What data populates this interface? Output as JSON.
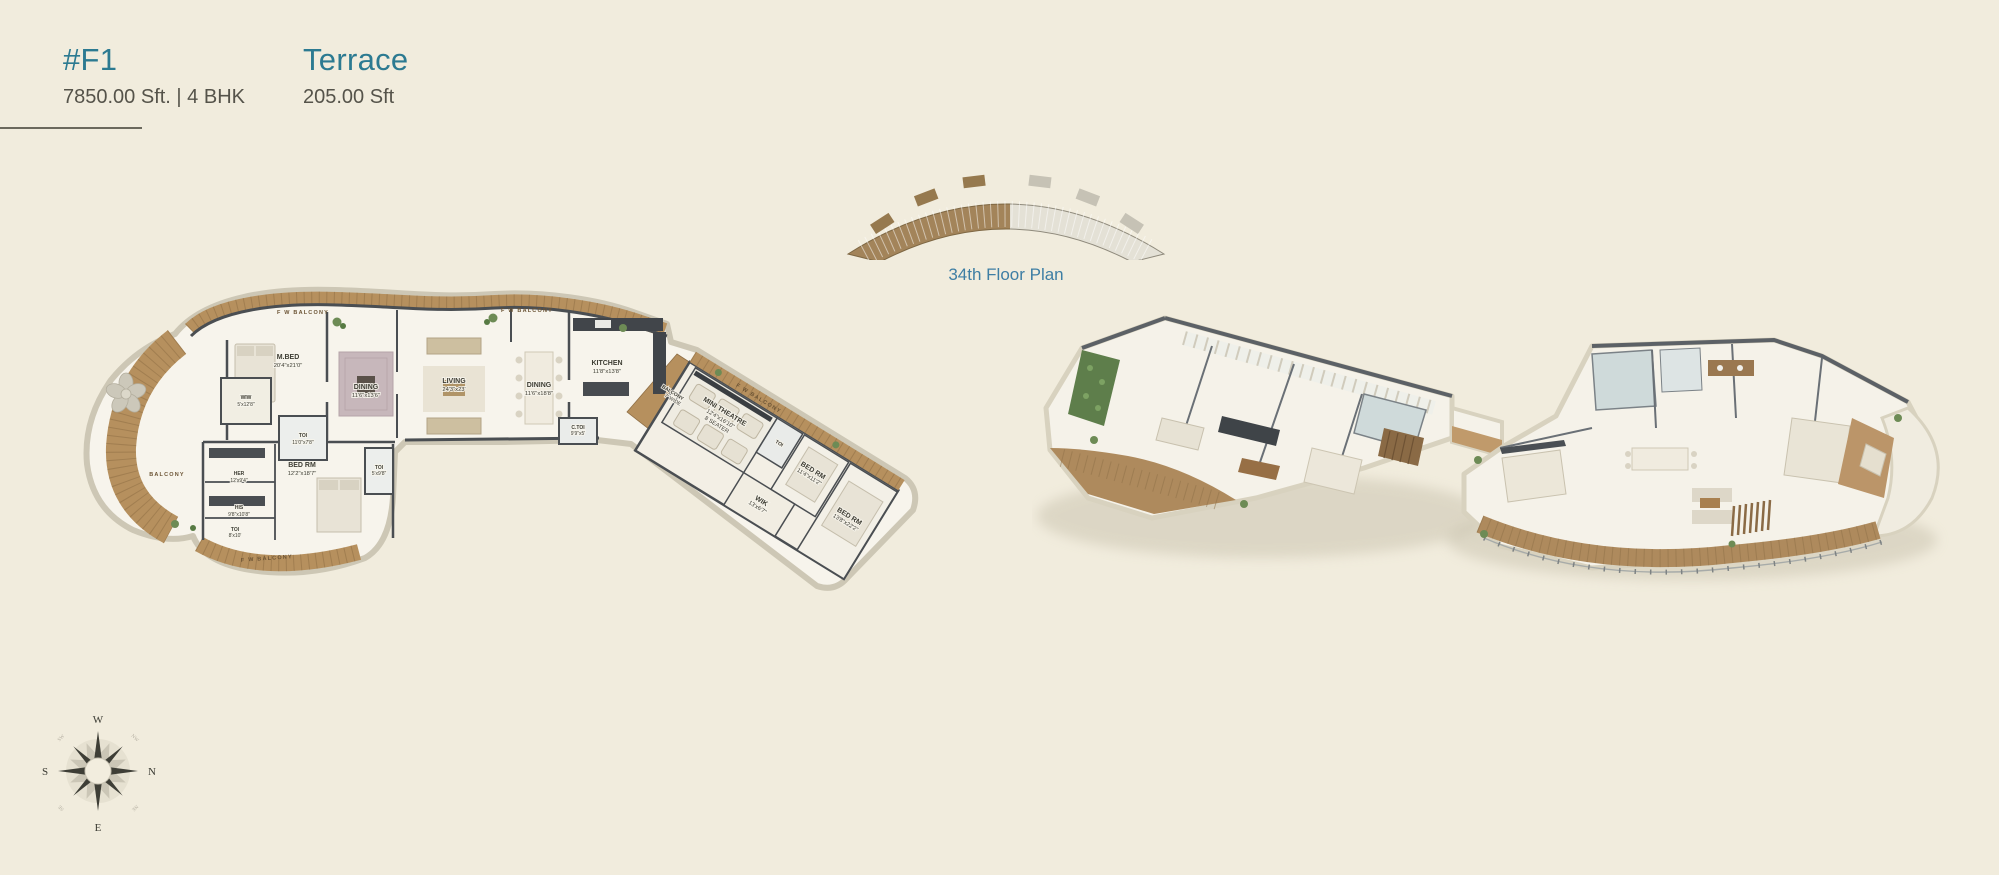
{
  "header": {
    "unit_id": "#F1",
    "unit_details": "7850.00 Sft. | 4 BHK",
    "terrace_title": "Terrace",
    "terrace_details": "205.00 Sft"
  },
  "key_plan": {
    "caption": "34th Floor Plan"
  },
  "plan_2d": {
    "balcony_label": "F W BALCONY",
    "left_balcony_label": "BALCONY",
    "connector_balcony": {
      "name": "BALCONY",
      "dims": "7' WIDE"
    },
    "rooms": [
      {
        "name": "M.BED",
        "dims": "20'4\"x21'0\""
      },
      {
        "name": "WIW",
        "dims": "5'x12'8\""
      },
      {
        "name": "TOI",
        "dims": "11'0\"x7'8\""
      },
      {
        "name": "DINING",
        "dims": "11'6\"x13'6\""
      },
      {
        "name": "LIVING",
        "dims": "24'3\"x23'"
      },
      {
        "name": "DINING",
        "dims": "11'6\"x18'8\""
      },
      {
        "name": "KITCHEN",
        "dims": "11'8\"x13'8\""
      },
      {
        "name": "C.TOI",
        "dims": "9'9\"x5'"
      },
      {
        "name": "HER",
        "dims": "12'x9'4\""
      },
      {
        "name": "HIS",
        "dims": "9'8\"x10'8\""
      },
      {
        "name": "TOI",
        "dims": "8'x10'"
      },
      {
        "name": "BED RM",
        "dims": "12'2\"x18'7\""
      },
      {
        "name": "TOI",
        "dims": "5'x9'8\""
      },
      {
        "name": "MINI THEATRE",
        "dims": "12'4\"x16'10\"",
        "extra": "8 SEATER"
      },
      {
        "name": "TOI",
        "dims": ""
      },
      {
        "name": "BED RM",
        "dims": "11'4\"x11'2\""
      },
      {
        "name": "BED RM",
        "dims": "13'8\"x22'2\""
      },
      {
        "name": "WIK",
        "dims": "13'x6'7\""
      }
    ]
  },
  "compass": {
    "top": "W",
    "right": "N",
    "bottom": "E",
    "left": "S",
    "diagonals": [
      "NW",
      "NE",
      "SE",
      "SW"
    ]
  },
  "colors": {
    "background": "#f1ecdd",
    "accent_teal": "#2c7a91",
    "link_teal": "#3e7ea4",
    "text_gray": "#55534a",
    "wood": "#b6905e",
    "highlight_brown": "#a3845a",
    "wall_dark": "#4a4e52"
  }
}
